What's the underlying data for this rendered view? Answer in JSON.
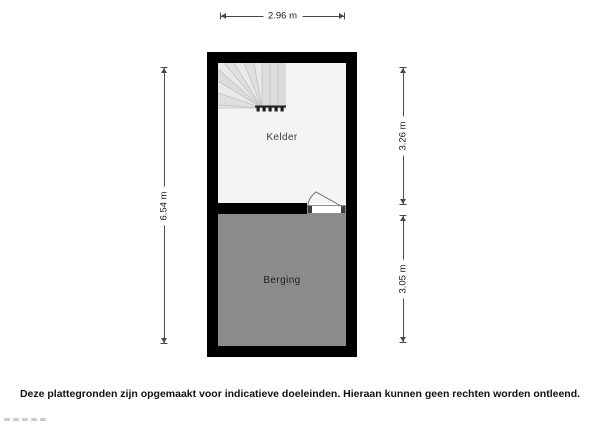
{
  "floorplan": {
    "rooms": [
      {
        "label": "Kelder"
      },
      {
        "label": "Berging"
      }
    ],
    "dimensions": {
      "width_total": "2.96 m",
      "height_total": "6.54 m",
      "kelder_height": "3.26 m",
      "berging_height": "3.05 m"
    },
    "icons": {
      "stairs": "winder-staircase-icon",
      "door": "door-swing-icon"
    }
  },
  "footer": {
    "disclaimer": "Deze plattegronden zijn opgemaakt voor indicatieve doeleinden. Hieraan kunnen geen rechten worden ontleend."
  },
  "colors": {
    "wall": "#000000",
    "kelder_floor": "#f4f4f4",
    "berging_floor": "#8b8b8b",
    "stairs_fill": "#e4e4e4",
    "stairs_line": "#bfbfbf",
    "dimension_line": "#4a4a4a",
    "dimension_text": "#1c1c1c",
    "door_outline": "#8e8e8e"
  }
}
